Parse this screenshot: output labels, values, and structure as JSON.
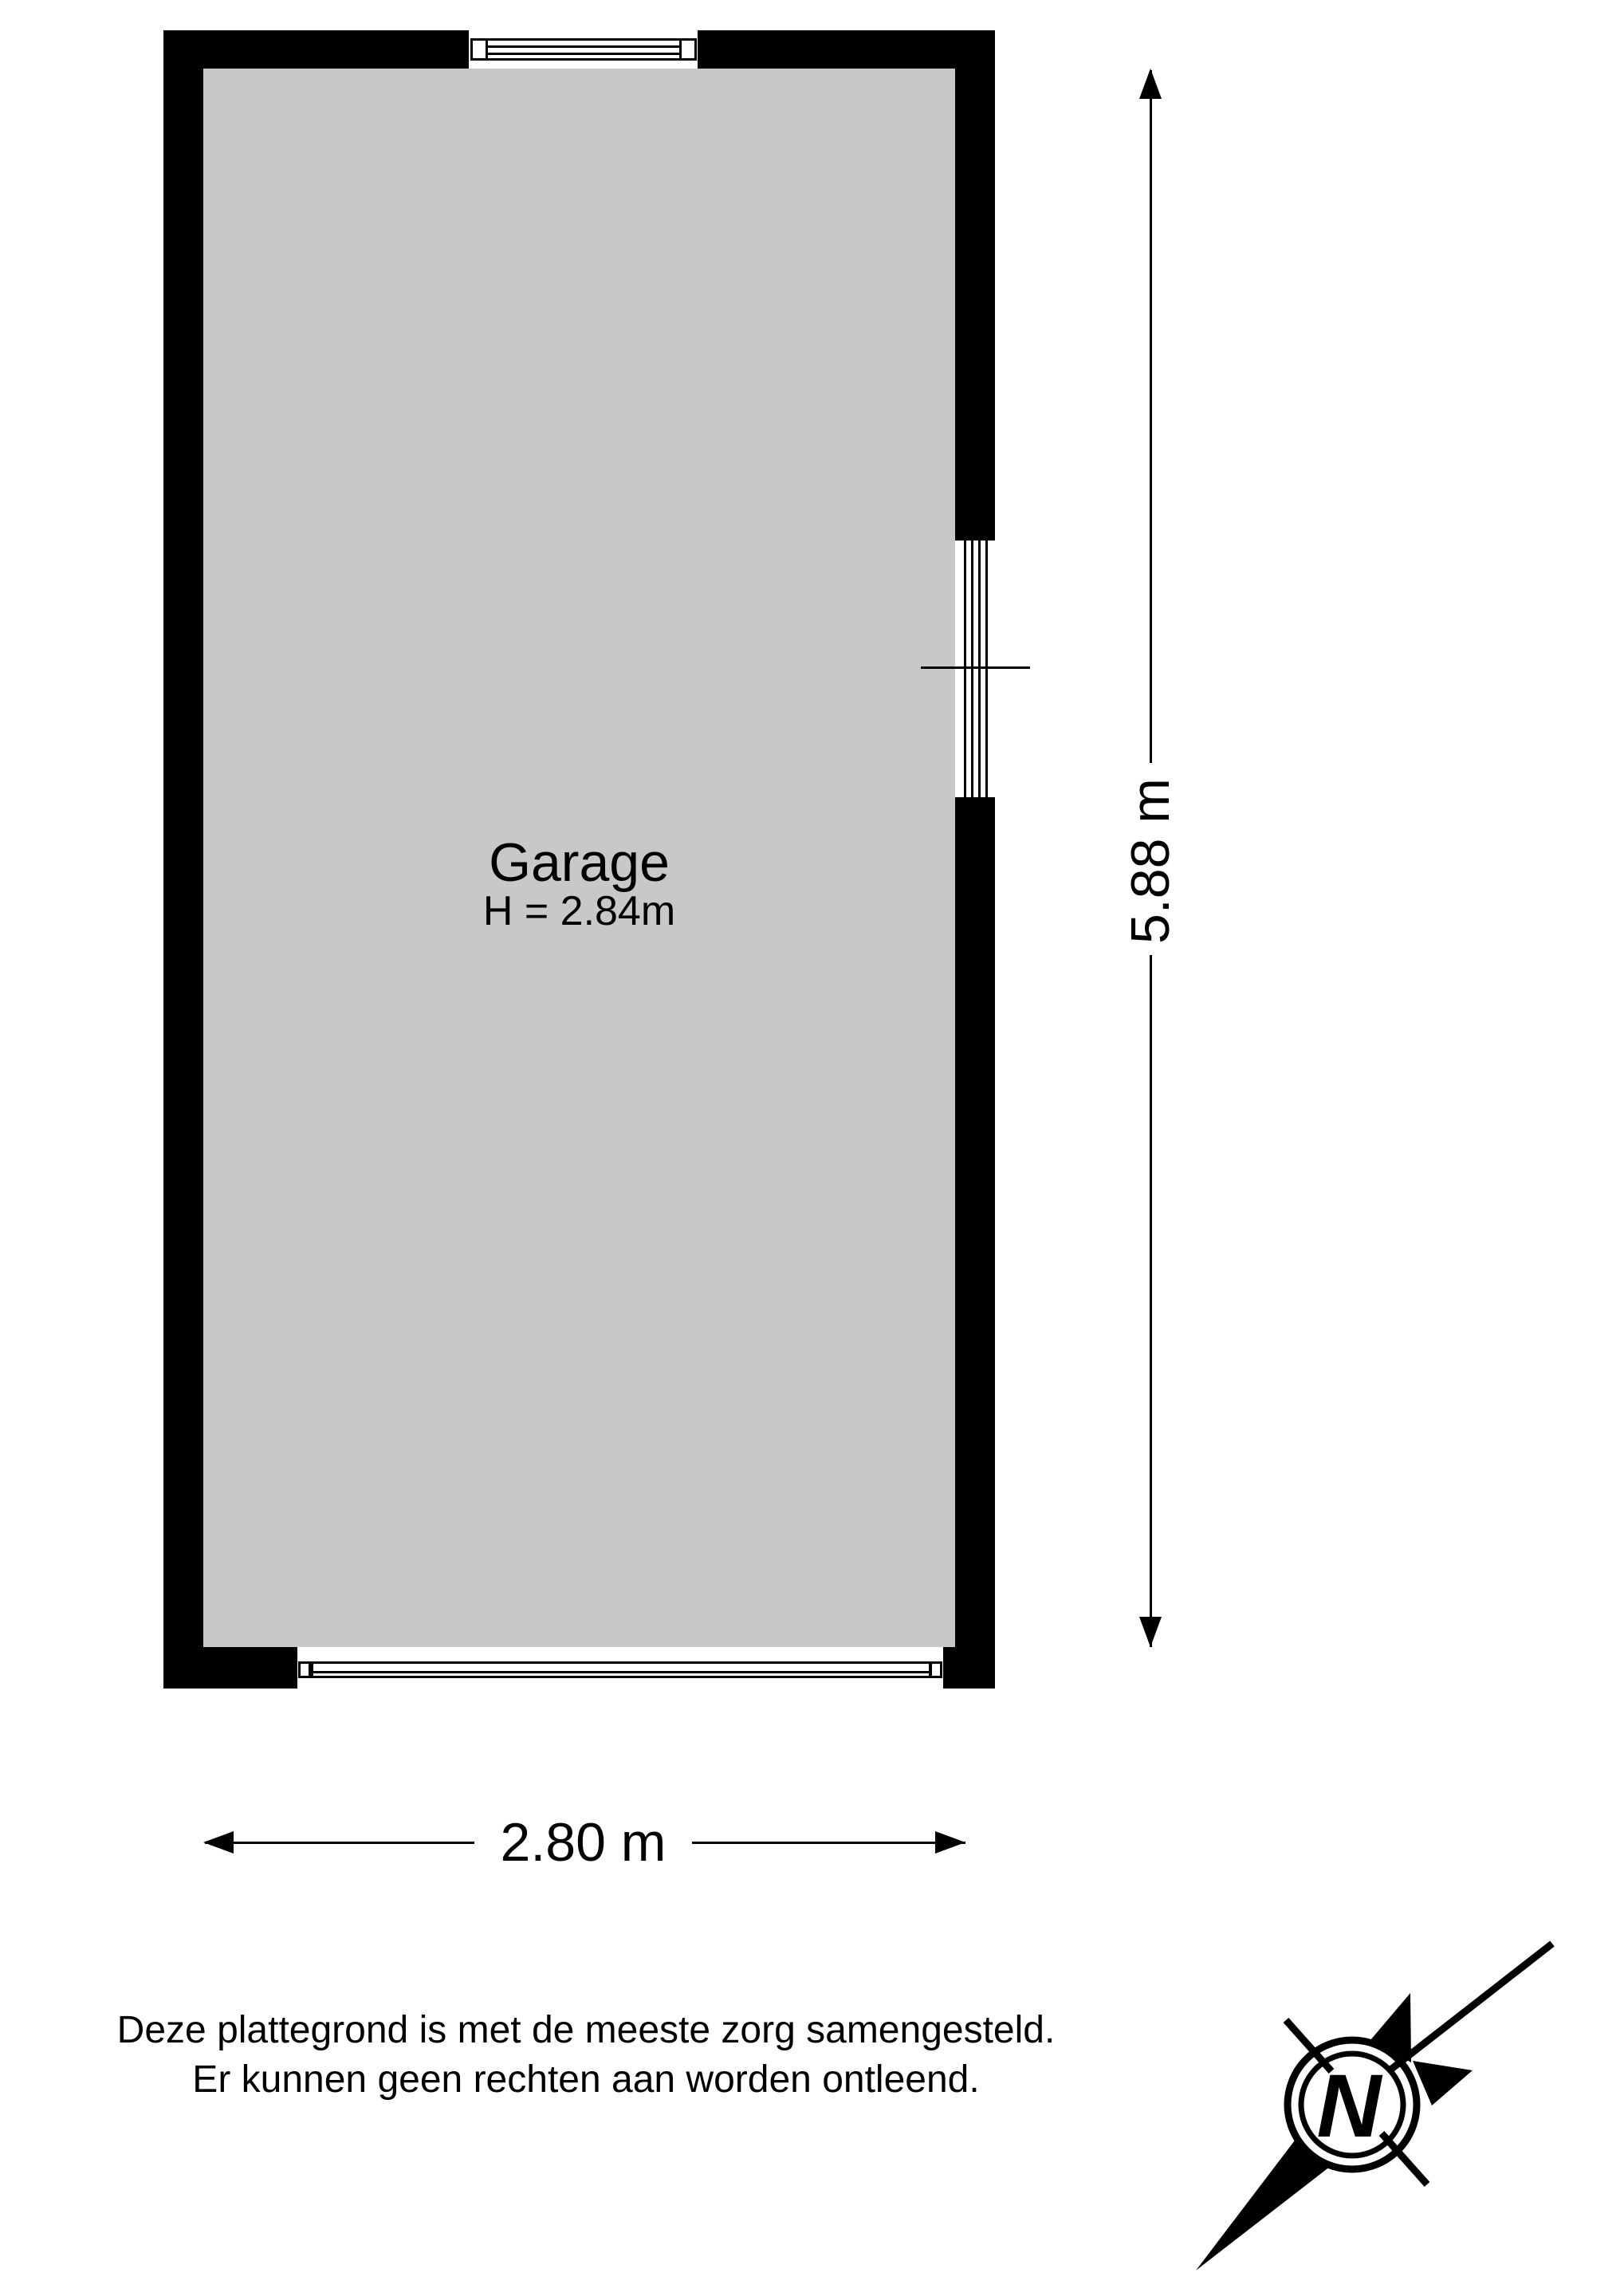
{
  "floor_plan": {
    "room": {
      "label": "Garage",
      "ceiling_height": "H = 2.84m"
    },
    "dimensions": {
      "width_label": "2.80 m",
      "height_label": "5.88 m"
    }
  },
  "disclaimer": {
    "line1": "Deze plattegrond is met de meeste zorg samengesteld.",
    "line2": "Er kunnen geen rechten aan worden ontleend."
  },
  "compass": {
    "north_label": "N"
  },
  "colors": {
    "wall": "#000000",
    "floor": "#c8c8c8",
    "background": "#ffffff",
    "ink": "#000000"
  }
}
